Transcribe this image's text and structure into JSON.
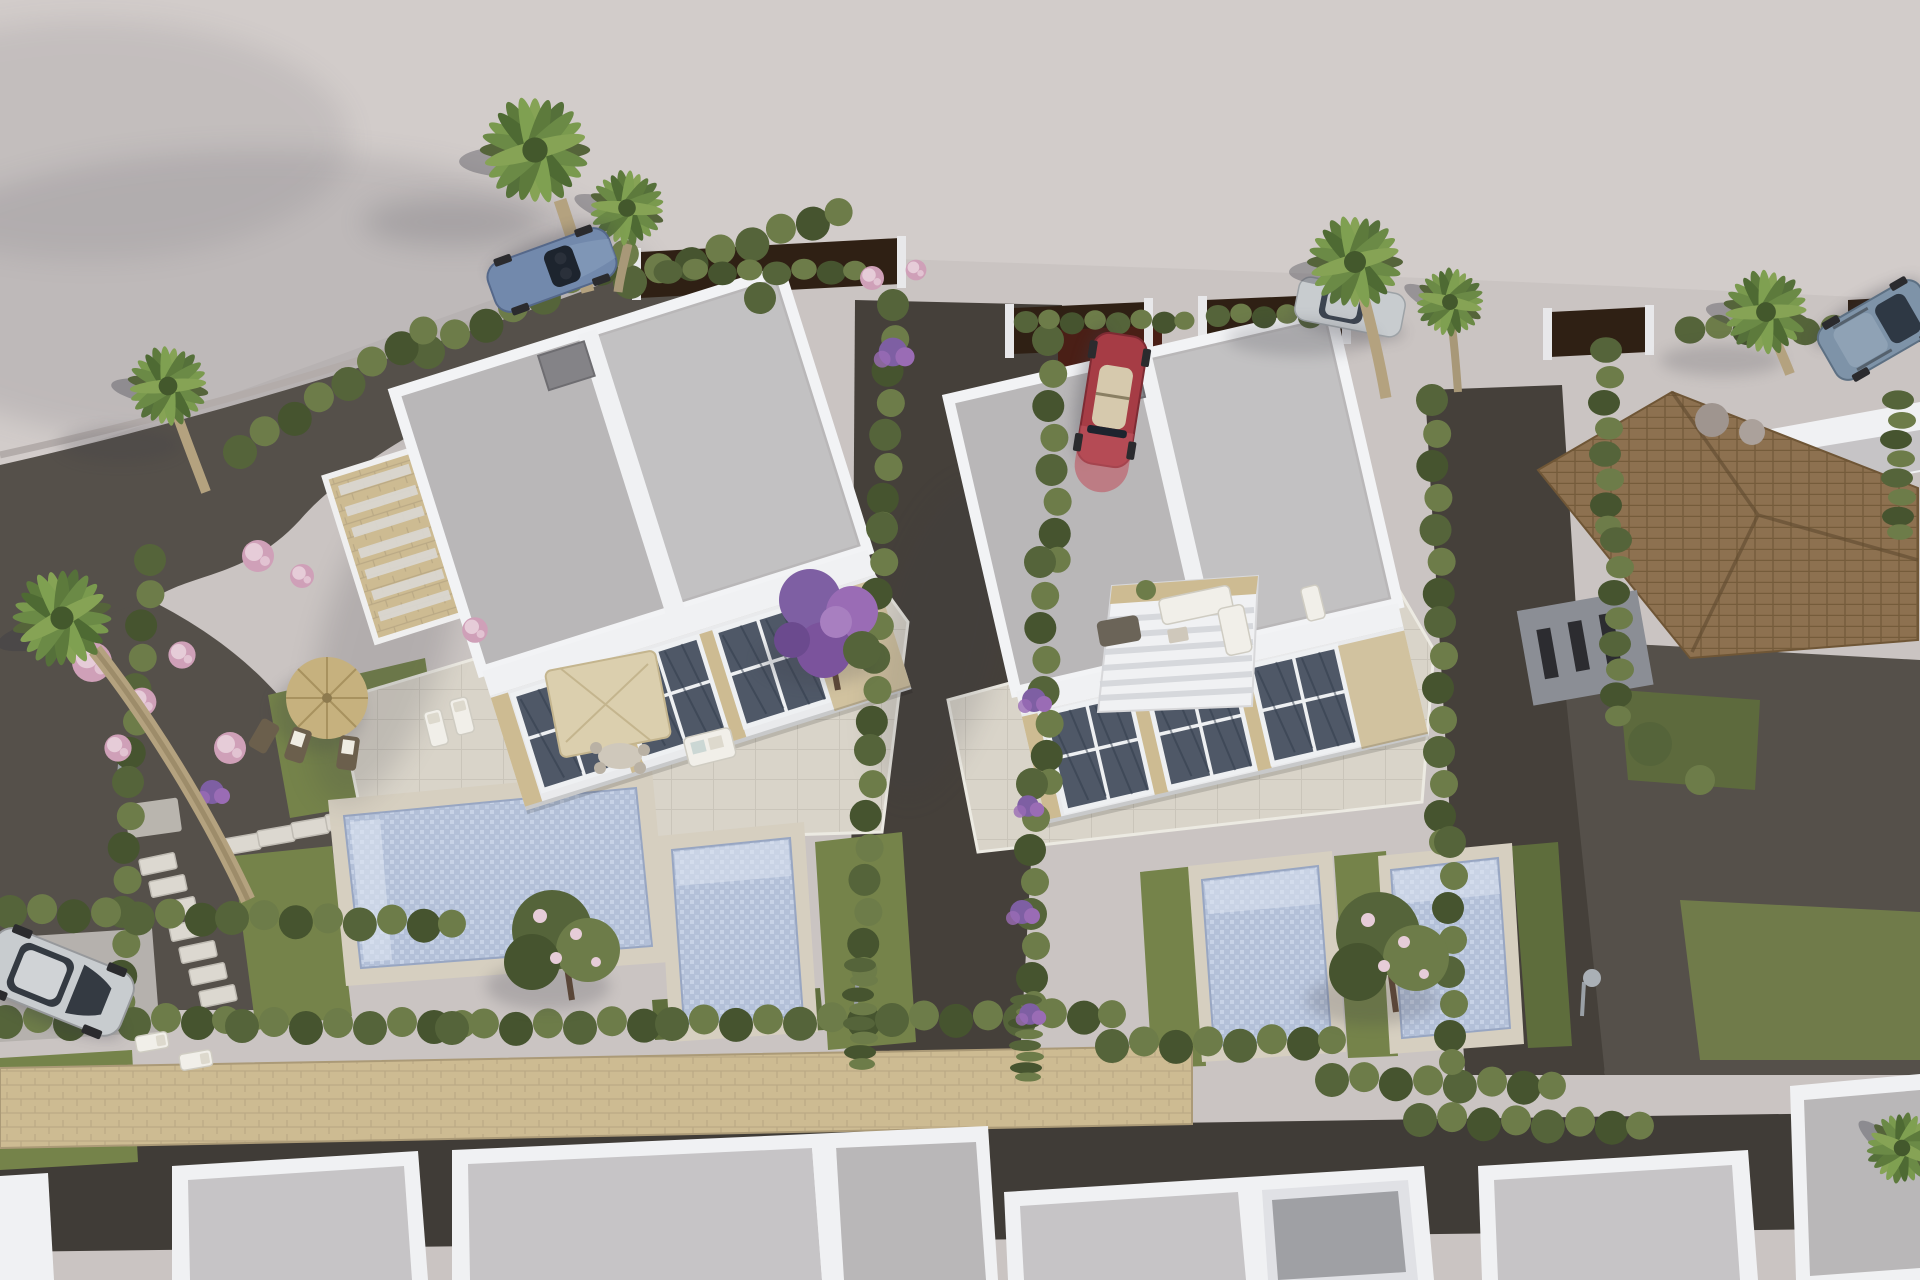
{
  "scene": {
    "type": "aerial-3d-architectural-render",
    "description": "Bird's-eye 3D visualization of a residential development: two modern flat-roof white villas with rooftop terraces, private gardens, swimming pools, cypress hedges, palm trees and parked cars; a row of neighbouring white houses below a stone wall and a tile-roof house at right.",
    "villas": 2,
    "pools": 4,
    "palm_trees": 8,
    "cars": [
      {
        "name": "blue-sports-car",
        "color_name": "steel blue",
        "location": "top-left road"
      },
      {
        "name": "red-convertible-car",
        "color_name": "red",
        "location": "center driveway"
      },
      {
        "name": "silver-parked-car",
        "color_name": "silver",
        "location": "behind palms, top center-right"
      },
      {
        "name": "suv-car",
        "color_name": "blue-gray",
        "location": "top-right road"
      },
      {
        "name": "silver-hatchback-car",
        "color_name": "silver",
        "location": "bottom-left drive"
      }
    ],
    "garden_features": [
      "straw-parasol",
      "beige-parasol",
      "sun-loungers",
      "outdoor-sofa",
      "stepping-stone-path",
      "pink-flower-shrubs",
      "purple-bougainvillea",
      "outdoor-shower",
      "stone-boundary-wall",
      "dark-wood-fence-panels"
    ]
  },
  "palette": {
    "ground": "#cac4c2",
    "road": "#d3cecc",
    "gravel": "#45403a",
    "gravel2": "#55504a",
    "lawn": "#75834a",
    "lawn2": "#5e6d3c",
    "hedge": "#6d7c49",
    "hedge2": "#55643a",
    "hedge3": "#46542f",
    "white": "#f0f1f3",
    "white2": "#e0e1e5",
    "roof": "#b9b7b8",
    "roof2": "#c6c4c6",
    "stone": "#cdbb92",
    "deck": "#d6cfc0",
    "terrace": "#d9d4c9",
    "pool": "#b3c0d8",
    "pool2": "#ccd7ea",
    "fence": "#2f2014",
    "gate": "#4a1f16",
    "glass": "#4f5867",
    "terracotta": "#8d7150",
    "terracotta2": "#6f5636",
    "pink": "#cfa0b8",
    "pink2": "#e6ccd8",
    "purple": "#7e5fa3",
    "purple2": "#9a6cb5",
    "straw": "#c6b17e",
    "parasol": "#dbcfae",
    "trunk": "#b0a07c",
    "car_red": "#a63c45",
    "car_blue": "#7289ac",
    "car_suv": "#7e93a8",
    "car_silver": "#c8cccf",
    "dark": "#2b2b2e"
  }
}
